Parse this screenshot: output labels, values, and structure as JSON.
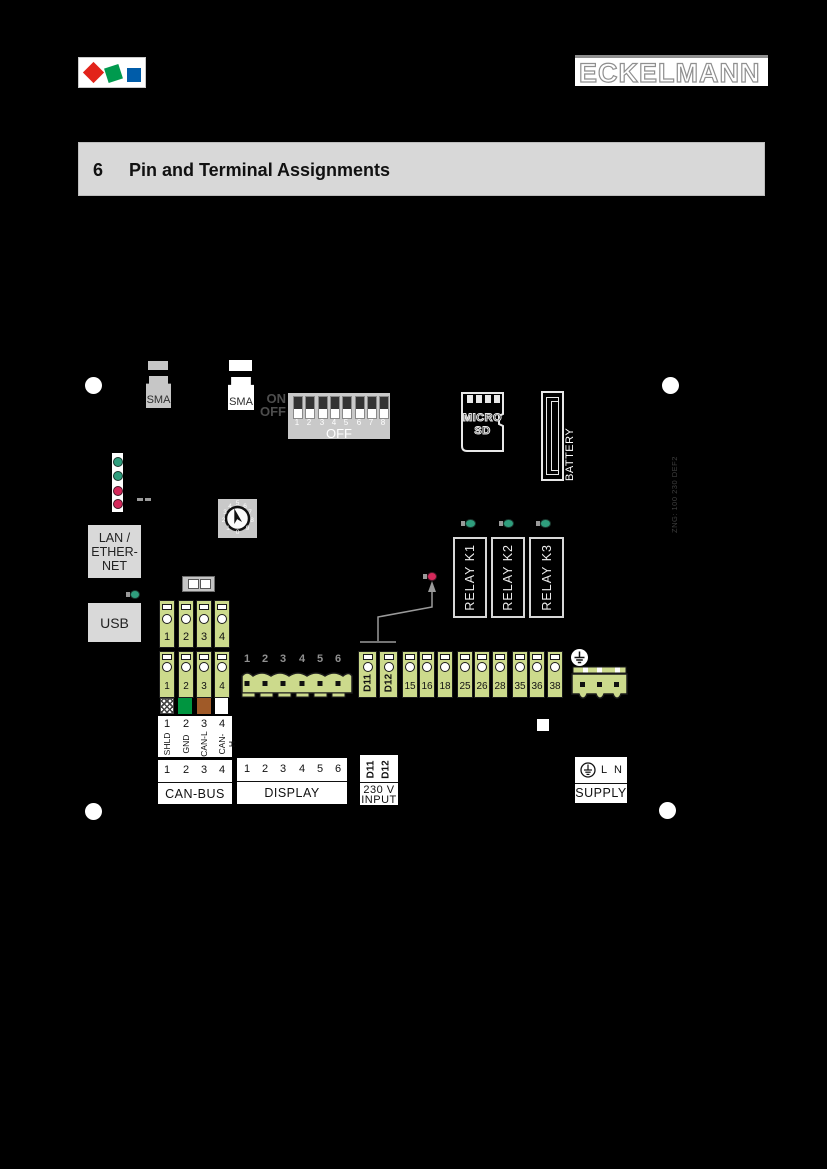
{
  "header": {
    "brand": "ECKELMANN",
    "logo_colors": {
      "red": "#e2231a",
      "green": "#009a4e",
      "blue": "#005ca9"
    }
  },
  "section": {
    "number": "6",
    "title": "Pin and Terminal Assignments"
  },
  "board": {
    "sma1": "SMA",
    "sma2": "SMA",
    "dip": {
      "on": "ON",
      "off": "OFF",
      "numbers": [
        "1",
        "2",
        "3",
        "4",
        "5",
        "6",
        "7",
        "8"
      ],
      "bottom_label": "OFF"
    },
    "microsd": {
      "line1": "MICRO",
      "line2": "SD"
    },
    "battery": "BATTERY",
    "board_code": "ZNG: 100 230 DEF2",
    "rotary": {
      "digits": [
        "0",
        "1",
        "2",
        "3",
        "4",
        "5",
        "6",
        "7",
        "8",
        "9"
      ]
    },
    "lan": {
      "line1": "LAN /",
      "line2": "ETHER-",
      "line3": "NET"
    },
    "usb": "USB",
    "can_upper": [
      "1",
      "2",
      "3",
      "4"
    ],
    "can_lower": [
      "1",
      "2",
      "3",
      "4"
    ],
    "display_pin_numbers": [
      "1",
      "2",
      "3",
      "4",
      "5",
      "6"
    ],
    "digital_inputs": [
      "D11",
      "D12"
    ],
    "relay_terminals": [
      "15",
      "16",
      "18",
      "25",
      "26",
      "28",
      "35",
      "36",
      "38"
    ],
    "relays": [
      "RELAY K1",
      "RELAY K2",
      "RELAY K3"
    ],
    "leds": {
      "status": [
        "green",
        "green",
        "red",
        "red"
      ],
      "usb": "green",
      "relay": [
        "green",
        "green",
        "green"
      ],
      "input_230v": "red"
    },
    "colors": {
      "terminal": "#ccda8c",
      "led_green": "#2f9e7d",
      "led_red": "#d5295b",
      "wire_green": "#009540",
      "wire_brown": "#a05a28"
    }
  },
  "labels": {
    "can_table": {
      "pins": [
        "1",
        "2",
        "3",
        "4"
      ],
      "signals": [
        "SHLD",
        "GND",
        "CAN-L",
        "CAN-H"
      ]
    },
    "can_bus": {
      "pins": [
        "1",
        "2",
        "3",
        "4"
      ],
      "title": "CAN-BUS"
    },
    "display": {
      "pins": [
        "1",
        "2",
        "3",
        "4",
        "5",
        "6"
      ],
      "title": "DISPLAY"
    },
    "input_230v": {
      "pins": [
        "D11",
        "D12"
      ],
      "line1": "230 V",
      "line2": "INPUT"
    },
    "supply": {
      "l": "L",
      "n": "N",
      "title": "SUPPLY"
    }
  }
}
